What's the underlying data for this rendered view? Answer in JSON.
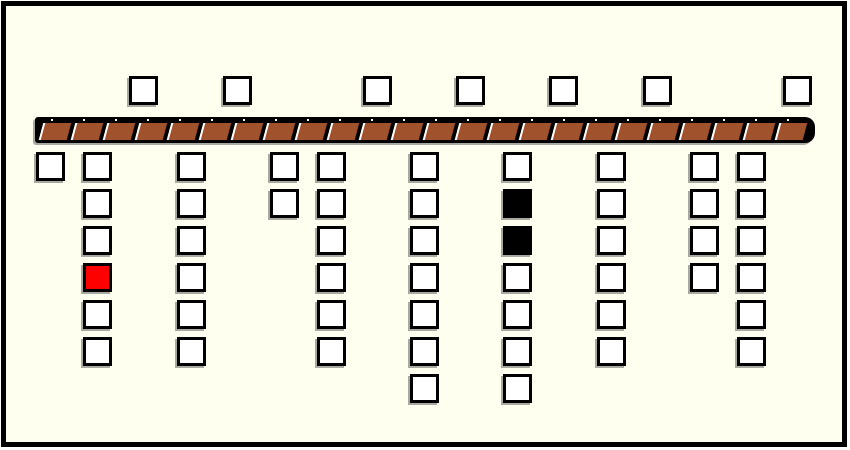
{
  "diagram": {
    "background_color": "#FFFFF0",
    "frame_border_color": "#000000",
    "shadow_color": "#a9a9a1",
    "square": {
      "size": 29,
      "border_width": 3,
      "border_color": "#000000",
      "fill_white": "#FFFFFF",
      "fill_red": "#FF0000",
      "fill_black": "#000000"
    },
    "top_row": {
      "y": 76,
      "xs": [
        129,
        223,
        363,
        456,
        549,
        643,
        783
      ],
      "count": 7
    },
    "belt": {
      "x": 35,
      "y": 117,
      "width": 780,
      "height": 26,
      "bar_color": "#000000",
      "segment_color": "#A0522D",
      "stripe_color": "#FFFFFF",
      "segment_count": 24,
      "segment_pitch": 32,
      "segment_width": 28,
      "segment_height": 17,
      "segment_top_offset": 6,
      "segment_start_offset": 6
    },
    "grid": {
      "row_y_start": 152,
      "row_pitch": 37,
      "row_count": 7,
      "columns": [
        {
          "x": 36,
          "rows": [
            1
          ],
          "specials": {}
        },
        {
          "x": 83,
          "rows": [
            1,
            2,
            3,
            4,
            5,
            6
          ],
          "specials": {
            "4": "red"
          }
        },
        {
          "x": 177,
          "rows": [
            1,
            2,
            3,
            4,
            5,
            6
          ],
          "specials": {}
        },
        {
          "x": 270,
          "rows": [
            1,
            2
          ],
          "specials": {}
        },
        {
          "x": 317,
          "rows": [
            1,
            2,
            3,
            4,
            5,
            6
          ],
          "specials": {}
        },
        {
          "x": 410,
          "rows": [
            1,
            2,
            3,
            4,
            5,
            6,
            7
          ],
          "specials": {}
        },
        {
          "x": 503,
          "rows": [
            1,
            2,
            3,
            4,
            5,
            6,
            7
          ],
          "specials": {
            "2": "black",
            "3": "black"
          }
        },
        {
          "x": 597,
          "rows": [
            1,
            2,
            3,
            4,
            5,
            6
          ],
          "specials": {}
        },
        {
          "x": 690,
          "rows": [
            1,
            2,
            3,
            4
          ],
          "specials": {}
        },
        {
          "x": 737,
          "rows": [
            1,
            2,
            3,
            4,
            5,
            6
          ],
          "specials": {}
        }
      ]
    }
  }
}
